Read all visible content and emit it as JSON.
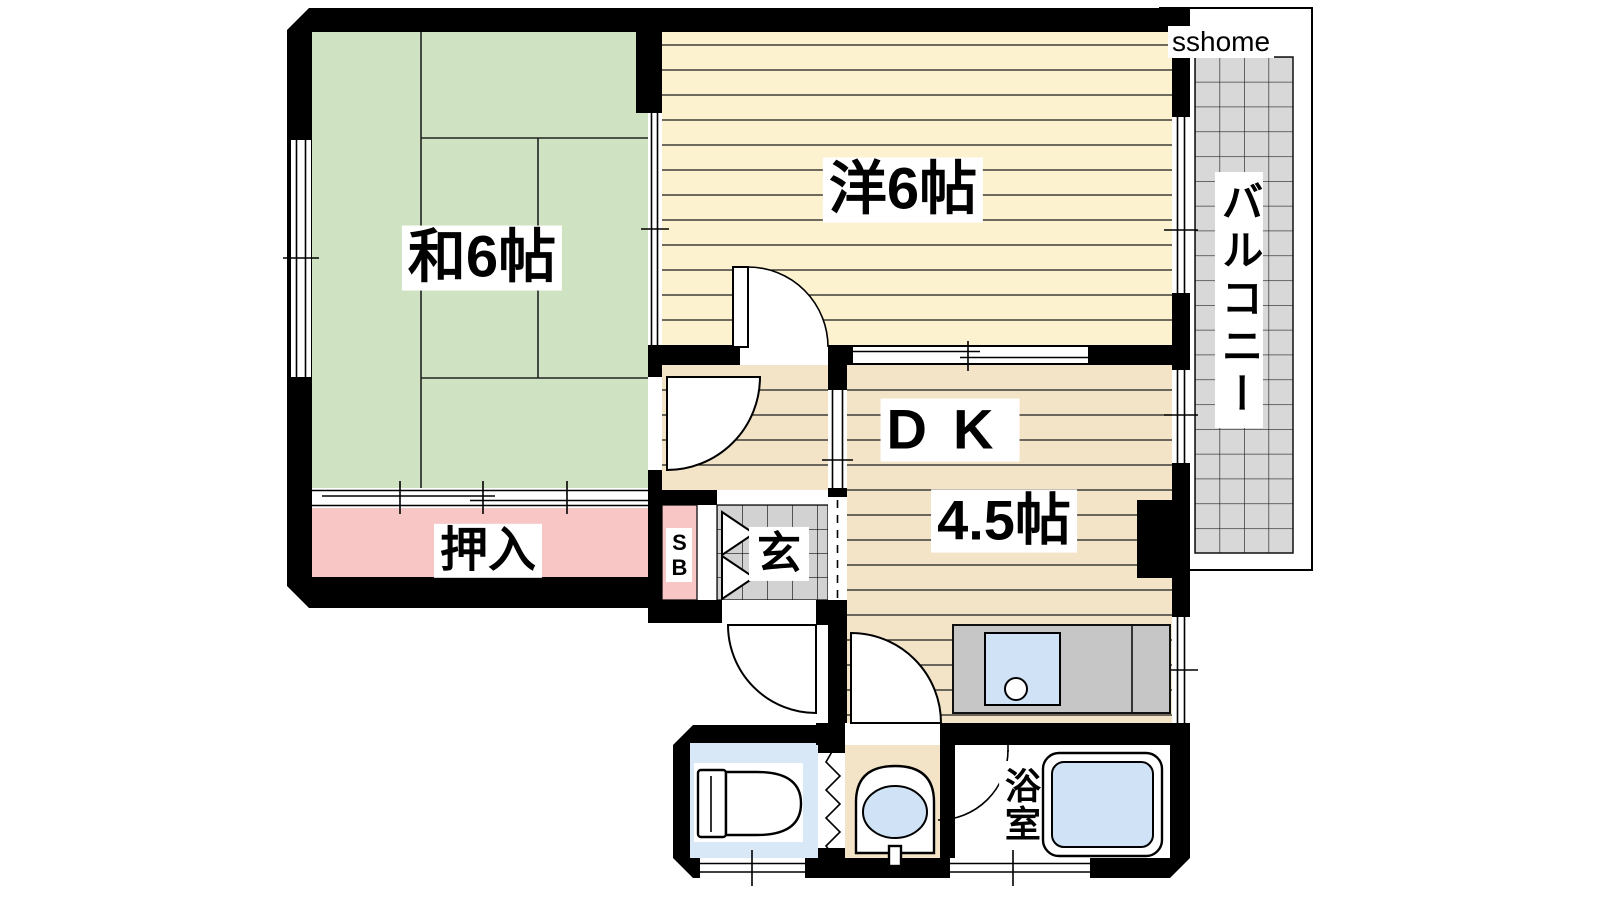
{
  "watermark": "sshome",
  "rooms": {
    "washitsu": {
      "label": "和6帖"
    },
    "yoshitsu": {
      "label": "洋6帖"
    },
    "dk": {
      "label_top": "DK",
      "label_bottom": "4.5帖"
    },
    "oshiire": {
      "label": "押入"
    },
    "genkan": {
      "label": "玄"
    },
    "shoebox": {
      "label": "SB"
    },
    "balcony": {
      "label": "バルコニー"
    },
    "bathroom": {
      "label": "浴室"
    }
  },
  "colors": {
    "wall": "#000000",
    "tatami": "#cfe2c2",
    "wood_light": "#fdf2d0",
    "wood": "#f3e4c8",
    "closet_pink": "#f9c6c6",
    "toilet_blue": "#d9e8f7",
    "water_blue": "#cfe2f6",
    "counter_gray": "#c6c6c6",
    "tile_gray": "#d2d2d2",
    "balcony_gray": "#d8d8d8"
  }
}
